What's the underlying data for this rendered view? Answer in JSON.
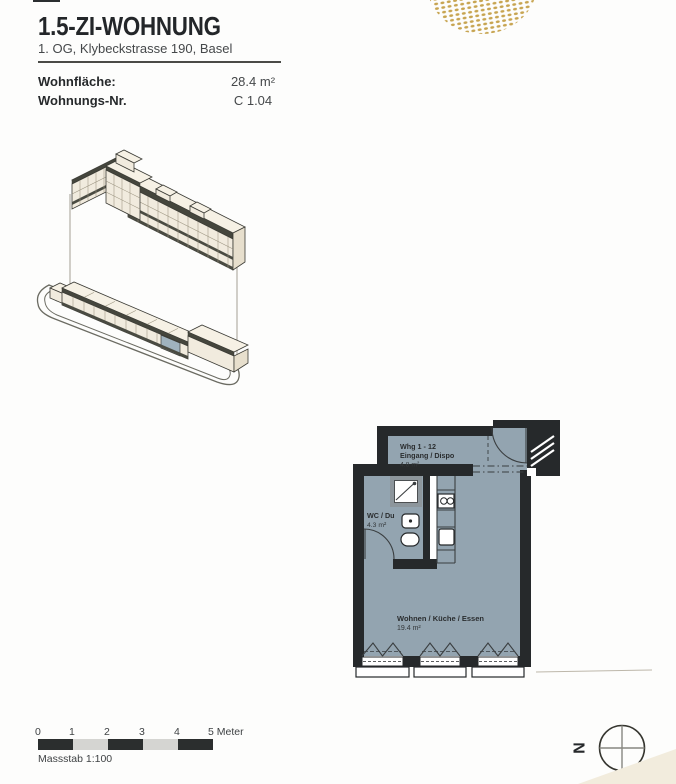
{
  "header": {
    "title": "1.5-ZI-WOHNUNG",
    "subtitle": "1. OG, Klybeckstrasse 190, Basel"
  },
  "info": {
    "rows": [
      {
        "label": "Wohnfläche:",
        "value": "28.4 m²"
      },
      {
        "label": "Wohnungs-Nr.",
        "value": "C 1.04"
      }
    ]
  },
  "decor": {
    "dot_color": "#c7a450",
    "corner_color": "#f2ecdd"
  },
  "site_plan": {
    "facade_color": "#f1ebde",
    "highlight_color": "#9fb2be"
  },
  "floor_plan": {
    "floor_color": "#93a4b0",
    "wall_color": "#26292b",
    "rooms": [
      {
        "line1": "Whg 1 - 12",
        "line2": "Eingang / Dispo",
        "area": "4.8 m²"
      },
      {
        "line1": "WC / Du",
        "area": "4.3 m²"
      },
      {
        "line1": "Wohnen / Küche / Essen",
        "area": "19.4 m²"
      }
    ]
  },
  "scale_bar": {
    "ticks": [
      "0",
      "1",
      "2",
      "3",
      "4",
      "5 Meter"
    ],
    "caption": "Massstab 1:100",
    "dark_color": "#2b2e2e",
    "light_color": "#d5d5d2"
  },
  "compass": {
    "label": "N"
  }
}
